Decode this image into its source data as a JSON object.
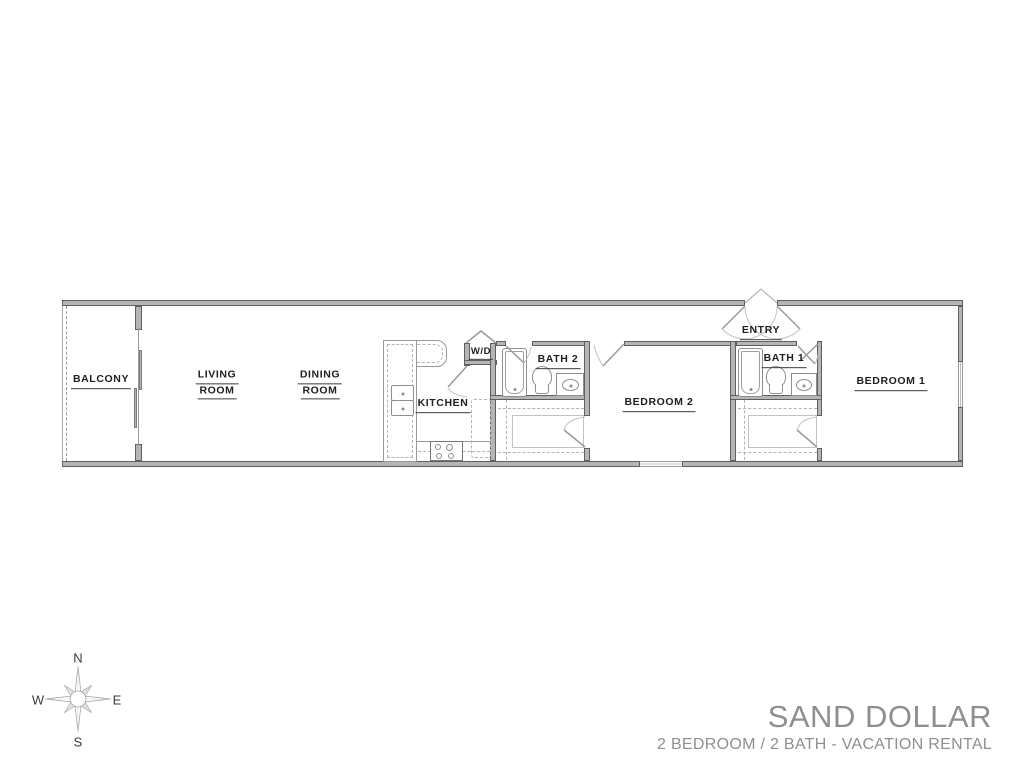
{
  "plan": {
    "rooms": {
      "balcony": {
        "label": "BALCONY"
      },
      "living": {
        "line1": "LIVING",
        "line2": "ROOM"
      },
      "dining": {
        "line1": "DINING",
        "line2": "ROOM"
      },
      "kitchen": {
        "label": "KITCHEN"
      },
      "wd": {
        "label": "W/D"
      },
      "bath2": {
        "label": "BATH 2"
      },
      "bedroom2": {
        "label": "BEDROOM 2"
      },
      "entry": {
        "label": "ENTRY"
      },
      "bath1": {
        "label": "BATH 1"
      },
      "bedroom1": {
        "label": "BEDROOM 1"
      }
    }
  },
  "compass": {
    "north": "N",
    "south": "S",
    "east": "E",
    "west": "W"
  },
  "title_block": {
    "title": "SAND DOLLAR",
    "subtitle": "2 BEDROOM / 2 BATH - VACATION RENTAL"
  },
  "colors": {
    "wall_fill": "#b5b5b5",
    "wall_edge": "#5f5f5f",
    "fixture_line": "#8f8f8f",
    "label_text": "#1f1f1f",
    "title_text": "#8f8f8f"
  }
}
